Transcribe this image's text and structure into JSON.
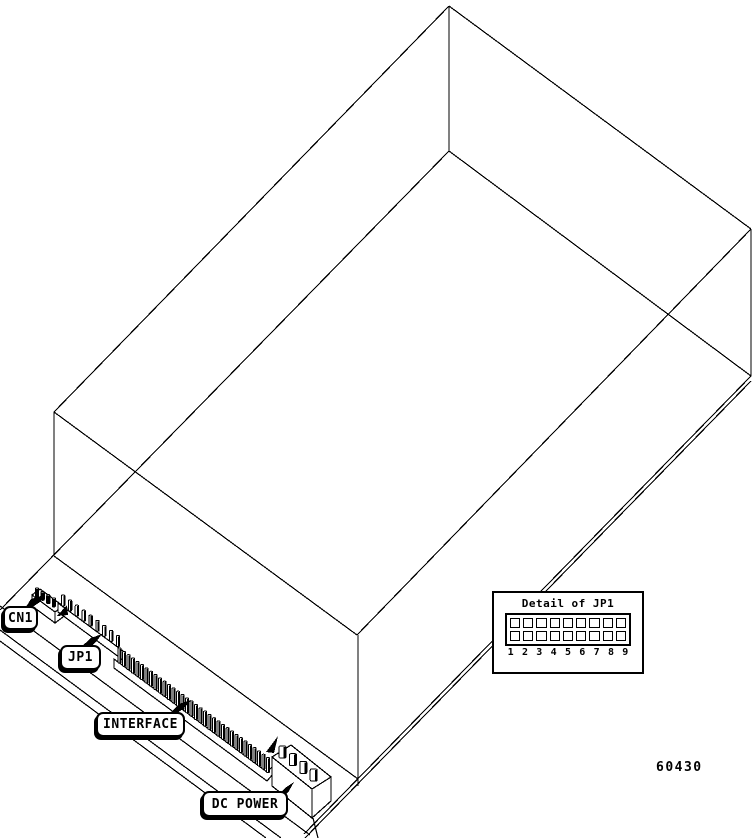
{
  "figure": {
    "part_number": "60430",
    "labels": {
      "cn1": "CN1",
      "jp1": "JP1",
      "interface": "INTERFACE",
      "dc_power": "DC POWER"
    },
    "detail_inset": {
      "title": "Detail of JP1",
      "rows": 2,
      "pin_numbers": [
        "1",
        "2",
        "3",
        "4",
        "5",
        "6",
        "7",
        "8",
        "9"
      ]
    },
    "connectors": {
      "cn1": {
        "visible_pins": 4
      },
      "jp1": {
        "visible_pins": 9
      },
      "interface": {
        "visible_pins": 34
      },
      "dc_power": {
        "visible_pins": 4
      }
    },
    "colors": {
      "line": "#000000",
      "background": "#ffffff"
    }
  }
}
